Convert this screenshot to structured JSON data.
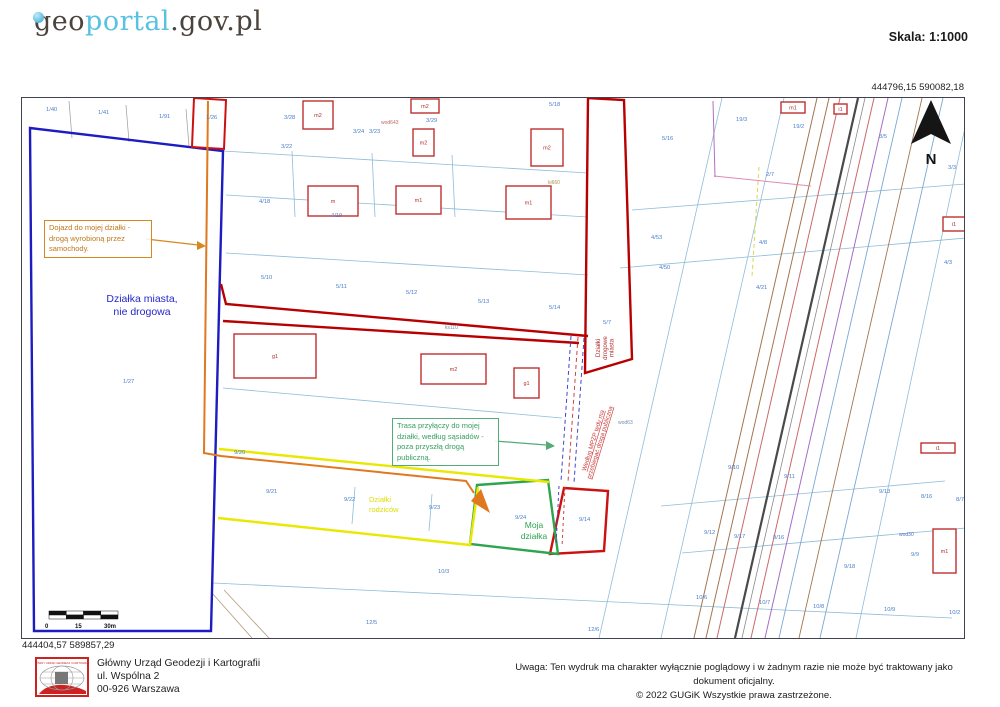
{
  "header": {
    "logo_geo": "geo",
    "logo_portal": "portal",
    "logo_suffix": ".gov.pl",
    "scale_label": "Skala:",
    "scale_value": "1:1000"
  },
  "colors": {
    "logo_accent": "#57c2e2",
    "parcel_label_blue": "#4a7fc9",
    "city_parcel_blue": "#1c1cc0",
    "road_red": "#b80000",
    "route_orange": "#e07820",
    "my_parcel_green": "#2da44e",
    "parents_yellow": "#e8e800",
    "annotation_orange": "#d4881f",
    "annotation_green": "#55aa77",
    "note_red": "#cc3838"
  },
  "map": {
    "coords_top_right": "444796,15  590082,18",
    "coords_bottom_left": "444404,57  589857,29",
    "annotations": {
      "access_road": "Dojazd do mojej działki - drogą wyrobioną przez samochody.",
      "city_parcel_line1": "Działka miasta,",
      "city_parcel_line2": "nie drogowa",
      "utility_route": "Trasa przyłączy do mojej działki, według sąsiadów - poza przyszłą drogą publiczną."
    },
    "texts": [
      {
        "name": "my-parcel-label",
        "lines": [
          "Moja",
          "działka"
        ],
        "x": 512,
        "y": 430,
        "size": 8.5,
        "color": "#2da44e",
        "anchor": "middle",
        "lh": 11
      },
      {
        "name": "parents-parcels-label",
        "lines": [
          "Działki",
          "rodziców"
        ],
        "x": 347,
        "y": 404,
        "size": 7.5,
        "color": "#dede00",
        "anchor": "start",
        "lh": 10
      },
      {
        "name": "city-road-parcels-label",
        "lines": [
          "Działki",
          "drogowe",
          "miasta"
        ],
        "x": 578,
        "y": 250,
        "size": 6.2,
        "color": "#b03030",
        "anchor": "middle",
        "lh": 6.8,
        "rotate": -90
      },
      {
        "name": "mpzp-note",
        "lines": [
          "Według MPZP tędy ma",
          "przebiegać droga publiczna"
        ],
        "x": 573,
        "y": 343,
        "size": 6.2,
        "color": "#cc3838",
        "anchor": "middle",
        "lh": 7,
        "rotate": -73,
        "underline": true
      },
      {
        "name": "north-letter",
        "lines": [
          "N"
        ],
        "x": 909,
        "y": 66,
        "size": 15,
        "color": "#151515",
        "anchor": "middle",
        "bold": true,
        "serif": true
      }
    ],
    "scalebar": {
      "labels": [
        "0",
        "15",
        "30m"
      ]
    },
    "labels": [
      {
        "t": "1/40",
        "x": 24,
        "y": 13
      },
      {
        "t": "1/41",
        "x": 76,
        "y": 16
      },
      {
        "t": "1/91",
        "x": 137,
        "y": 20
      },
      {
        "t": "1/26",
        "x": 184,
        "y": 21
      },
      {
        "t": "1/27",
        "x": 101,
        "y": 285
      },
      {
        "t": "3/28",
        "x": 262,
        "y": 21
      },
      {
        "t": "3/24",
        "x": 331,
        "y": 35
      },
      {
        "t": "3/23",
        "x": 347,
        "y": 35
      },
      {
        "t": "3/22",
        "x": 259,
        "y": 50
      },
      {
        "t": "3/29",
        "x": 404,
        "y": 24
      },
      {
        "t": "5/18",
        "x": 527,
        "y": 8
      },
      {
        "t": "5/16",
        "x": 640,
        "y": 42
      },
      {
        "t": "4/18",
        "x": 237,
        "y": 105
      },
      {
        "t": "4/19",
        "x": 309,
        "y": 119
      },
      {
        "t": "5/10",
        "x": 239,
        "y": 181
      },
      {
        "t": "5/11",
        "x": 314,
        "y": 190
      },
      {
        "t": "5/12",
        "x": 384,
        "y": 196
      },
      {
        "t": "5/13",
        "x": 456,
        "y": 205
      },
      {
        "t": "5/14",
        "x": 527,
        "y": 211
      },
      {
        "t": "5/7",
        "x": 581,
        "y": 226
      },
      {
        "t": "4/53",
        "x": 629,
        "y": 141
      },
      {
        "t": "4/50",
        "x": 637,
        "y": 171
      },
      {
        "t": "19/3",
        "x": 714,
        "y": 23
      },
      {
        "t": "19/2",
        "x": 771,
        "y": 30
      },
      {
        "t": "3/5",
        "x": 857,
        "y": 40
      },
      {
        "t": "3/3",
        "x": 926,
        "y": 71
      },
      {
        "t": "2/7",
        "x": 744,
        "y": 78
      },
      {
        "t": "4/8",
        "x": 737,
        "y": 146
      },
      {
        "t": "4/21",
        "x": 734,
        "y": 191
      },
      {
        "t": "4/3",
        "x": 922,
        "y": 166
      },
      {
        "t": "9/20",
        "x": 212,
        "y": 356
      },
      {
        "t": "9/21",
        "x": 244,
        "y": 395
      },
      {
        "t": "9/22",
        "x": 322,
        "y": 403
      },
      {
        "t": "9/23",
        "x": 407,
        "y": 411
      },
      {
        "t": "9/24",
        "x": 493,
        "y": 421
      },
      {
        "t": "9/14",
        "x": 557,
        "y": 423
      },
      {
        "t": "9/10",
        "x": 706,
        "y": 371
      },
      {
        "t": "9/11",
        "x": 762,
        "y": 380
      },
      {
        "t": "9/12",
        "x": 682,
        "y": 436
      },
      {
        "t": "9/17",
        "x": 712,
        "y": 440
      },
      {
        "t": "9/16",
        "x": 751,
        "y": 441
      },
      {
        "t": "9/13",
        "x": 857,
        "y": 395
      },
      {
        "t": "8/16",
        "x": 899,
        "y": 400
      },
      {
        "t": "8/7",
        "x": 934,
        "y": 403
      },
      {
        "t": "9/9",
        "x": 889,
        "y": 458
      },
      {
        "t": "9/18",
        "x": 822,
        "y": 470
      },
      {
        "t": "10/3",
        "x": 416,
        "y": 475
      },
      {
        "t": "10/6",
        "x": 674,
        "y": 501
      },
      {
        "t": "10/7",
        "x": 737,
        "y": 506
      },
      {
        "t": "10/8",
        "x": 791,
        "y": 510
      },
      {
        "t": "10/9",
        "x": 862,
        "y": 513
      },
      {
        "t": "10/2",
        "x": 927,
        "y": 516
      },
      {
        "t": "12/5",
        "x": 344,
        "y": 526
      },
      {
        "t": "12/6",
        "x": 566,
        "y": 533
      },
      {
        "t": "wod643",
        "x": 359,
        "y": 26,
        "c": "#c06868",
        "s": 5
      },
      {
        "t": "ki660",
        "x": 526,
        "y": 86,
        "c": "#b09050",
        "s": 5
      },
      {
        "t": "ks110",
        "x": 423,
        "y": 231,
        "c": "#7090b0",
        "s": 5
      },
      {
        "t": "wod63",
        "x": 596,
        "y": 326,
        "c": "#7090b0",
        "s": 5
      },
      {
        "t": "wod30",
        "x": 877,
        "y": 438,
        "c": "#5070c0",
        "s": 5
      }
    ],
    "buildings": [
      {
        "label": "m2",
        "x": 281,
        "y": 3,
        "w": 30,
        "h": 28
      },
      {
        "label": "m2",
        "x": 389,
        "y": 1,
        "w": 28,
        "h": 14
      },
      {
        "label": "m2",
        "x": 391,
        "y": 31,
        "w": 21,
        "h": 27
      },
      {
        "label": "m2",
        "x": 509,
        "y": 31,
        "w": 32,
        "h": 37
      },
      {
        "label": "m",
        "x": 286,
        "y": 88,
        "w": 50,
        "h": 30
      },
      {
        "label": "m1",
        "x": 374,
        "y": 88,
        "w": 45,
        "h": 28
      },
      {
        "label": "m1",
        "x": 484,
        "y": 88,
        "w": 45,
        "h": 33
      },
      {
        "label": "g1",
        "x": 212,
        "y": 236,
        "w": 82,
        "h": 44
      },
      {
        "label": "m2",
        "x": 399,
        "y": 256,
        "w": 65,
        "h": 30
      },
      {
        "label": "g1",
        "x": 492,
        "y": 270,
        "w": 25,
        "h": 30
      },
      {
        "label": "m1",
        "x": 759,
        "y": 4,
        "w": 24,
        "h": 11
      },
      {
        "label": "i1",
        "x": 812,
        "y": 6,
        "w": 13,
        "h": 10
      },
      {
        "label": "i1",
        "x": 921,
        "y": 119,
        "w": 22,
        "h": 14
      },
      {
        "label": "i1",
        "x": 899,
        "y": 345,
        "w": 34,
        "h": 10
      },
      {
        "label": "m1",
        "x": 911,
        "y": 431,
        "w": 23,
        "h": 44
      }
    ]
  },
  "footer": {
    "seal_text": "GŁÓWNY URZĄD GEODEZJI I KARTOGRAFII",
    "address": [
      "Główny Urząd Geodezji i Kartografii",
      "ul. Wspólna 2",
      "00-926 Warszawa"
    ],
    "notice_line1": "Uwaga: Ten wydruk ma charakter wyłącznie poglądowy i w żadnym razie nie może być traktowany jako dokument oficjalny.",
    "notice_line2": "© 2022 GUGiK Wszystkie prawa zastrzeżone."
  }
}
